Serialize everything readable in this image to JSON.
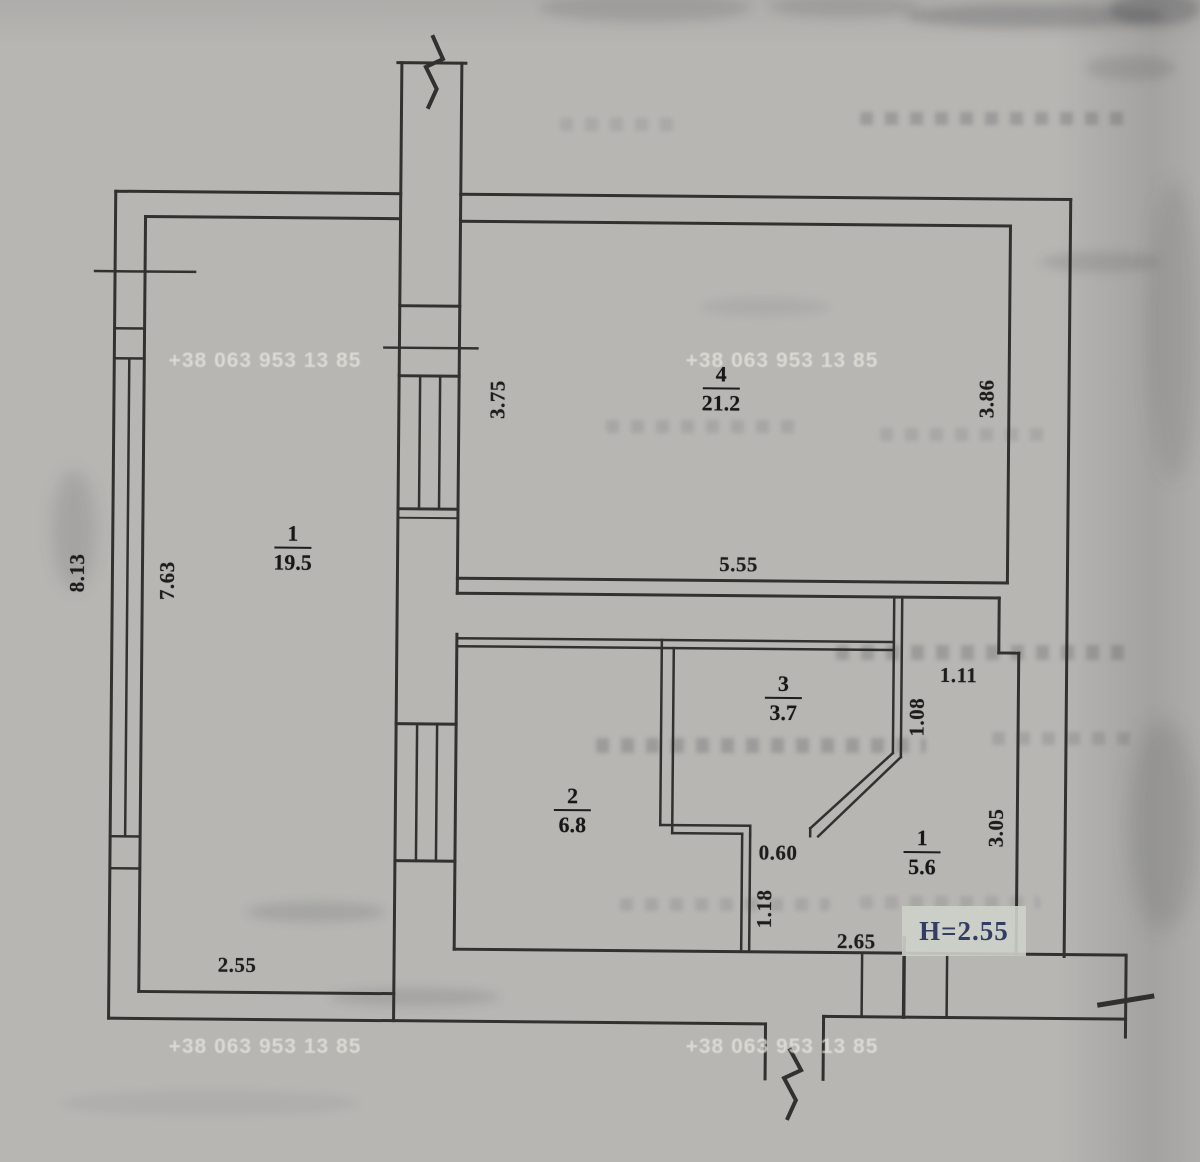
{
  "watermark": {
    "phone": "+38 063 953 13 85"
  },
  "rooms": {
    "living": {
      "number": "1",
      "area": "19.5"
    },
    "top": {
      "number": "4",
      "area": "21.2"
    },
    "small": {
      "number": "3",
      "area": "3.7"
    },
    "kitchen": {
      "number": "2",
      "area": "6.8"
    },
    "hall": {
      "number": "1",
      "area": "5.6"
    }
  },
  "dimensions": {
    "outer_left": "8.13",
    "inner_left": "7.63",
    "living_width": "2.55",
    "shaft_side": "3.75",
    "room4_width": "5.55",
    "room4_depth": "3.86",
    "niche_width": "1.11",
    "niche_depth": "1.08",
    "hall_depth": "3.05",
    "hall_width": "2.65",
    "opening_width": "0.60",
    "passage_depth": "1.18",
    "ceiling_height": "H=2.55"
  }
}
